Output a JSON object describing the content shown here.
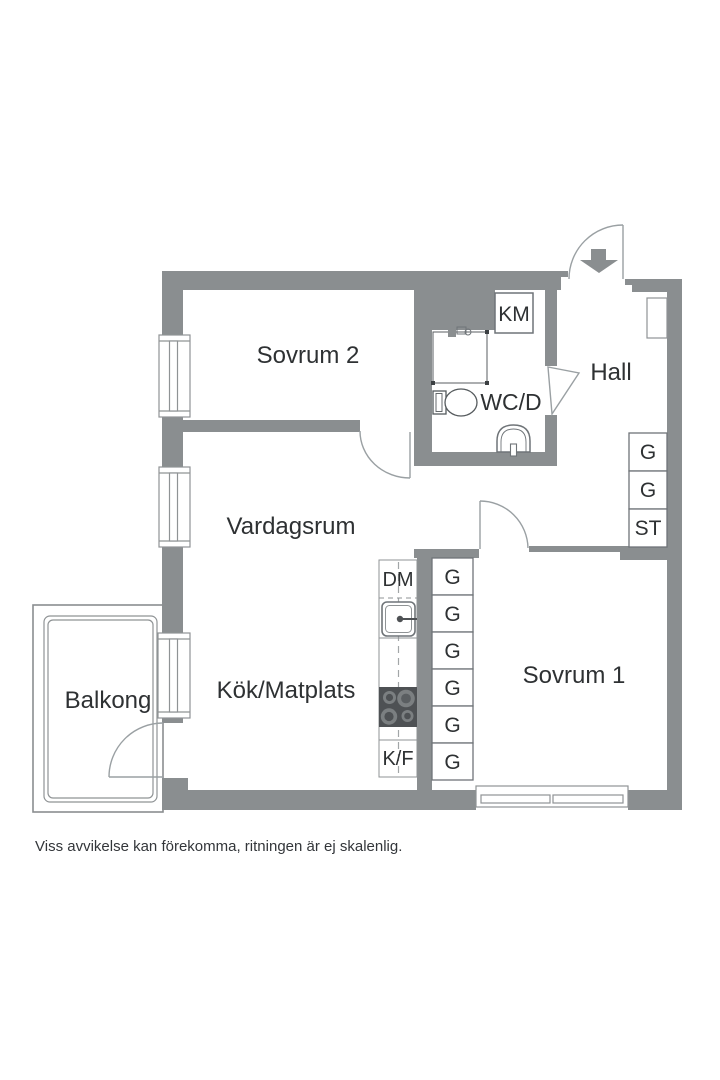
{
  "floor_plan": {
    "rooms": {
      "sovrum2": {
        "label": "Sovrum 2"
      },
      "hall": {
        "label": "Hall"
      },
      "wcd": {
        "label": "WC/D"
      },
      "vardagsrum": {
        "label": "Vardagsrum"
      },
      "kok": {
        "label": "Kök/Matplats"
      },
      "sovrum1": {
        "label": "Sovrum 1"
      },
      "balkong": {
        "label": "Balkong"
      }
    },
    "fixtures": {
      "washing_machine": "KM",
      "dishwasher": "DM",
      "fridge_freezer": "K/F"
    },
    "closets": {
      "hall_column": [
        "G",
        "G",
        "ST"
      ],
      "kitchen_column": [
        "G",
        "G",
        "G",
        "G",
        "G",
        "G"
      ]
    },
    "icons": [
      "entrance-arrow-icon",
      "toilet-icon",
      "washbasin-icon",
      "shower-icon",
      "kitchen-sink-icon",
      "stove-icon"
    ],
    "colors": {
      "wall": "#8a8e90",
      "thin_line": "#8f9395",
      "door_line": "#9aa0a3",
      "stove_dark": "#4e5154",
      "text": "#2e3133"
    },
    "disclaimer": "Viss avvikelse kan förekomma, ritningen är ej skalenlig."
  }
}
